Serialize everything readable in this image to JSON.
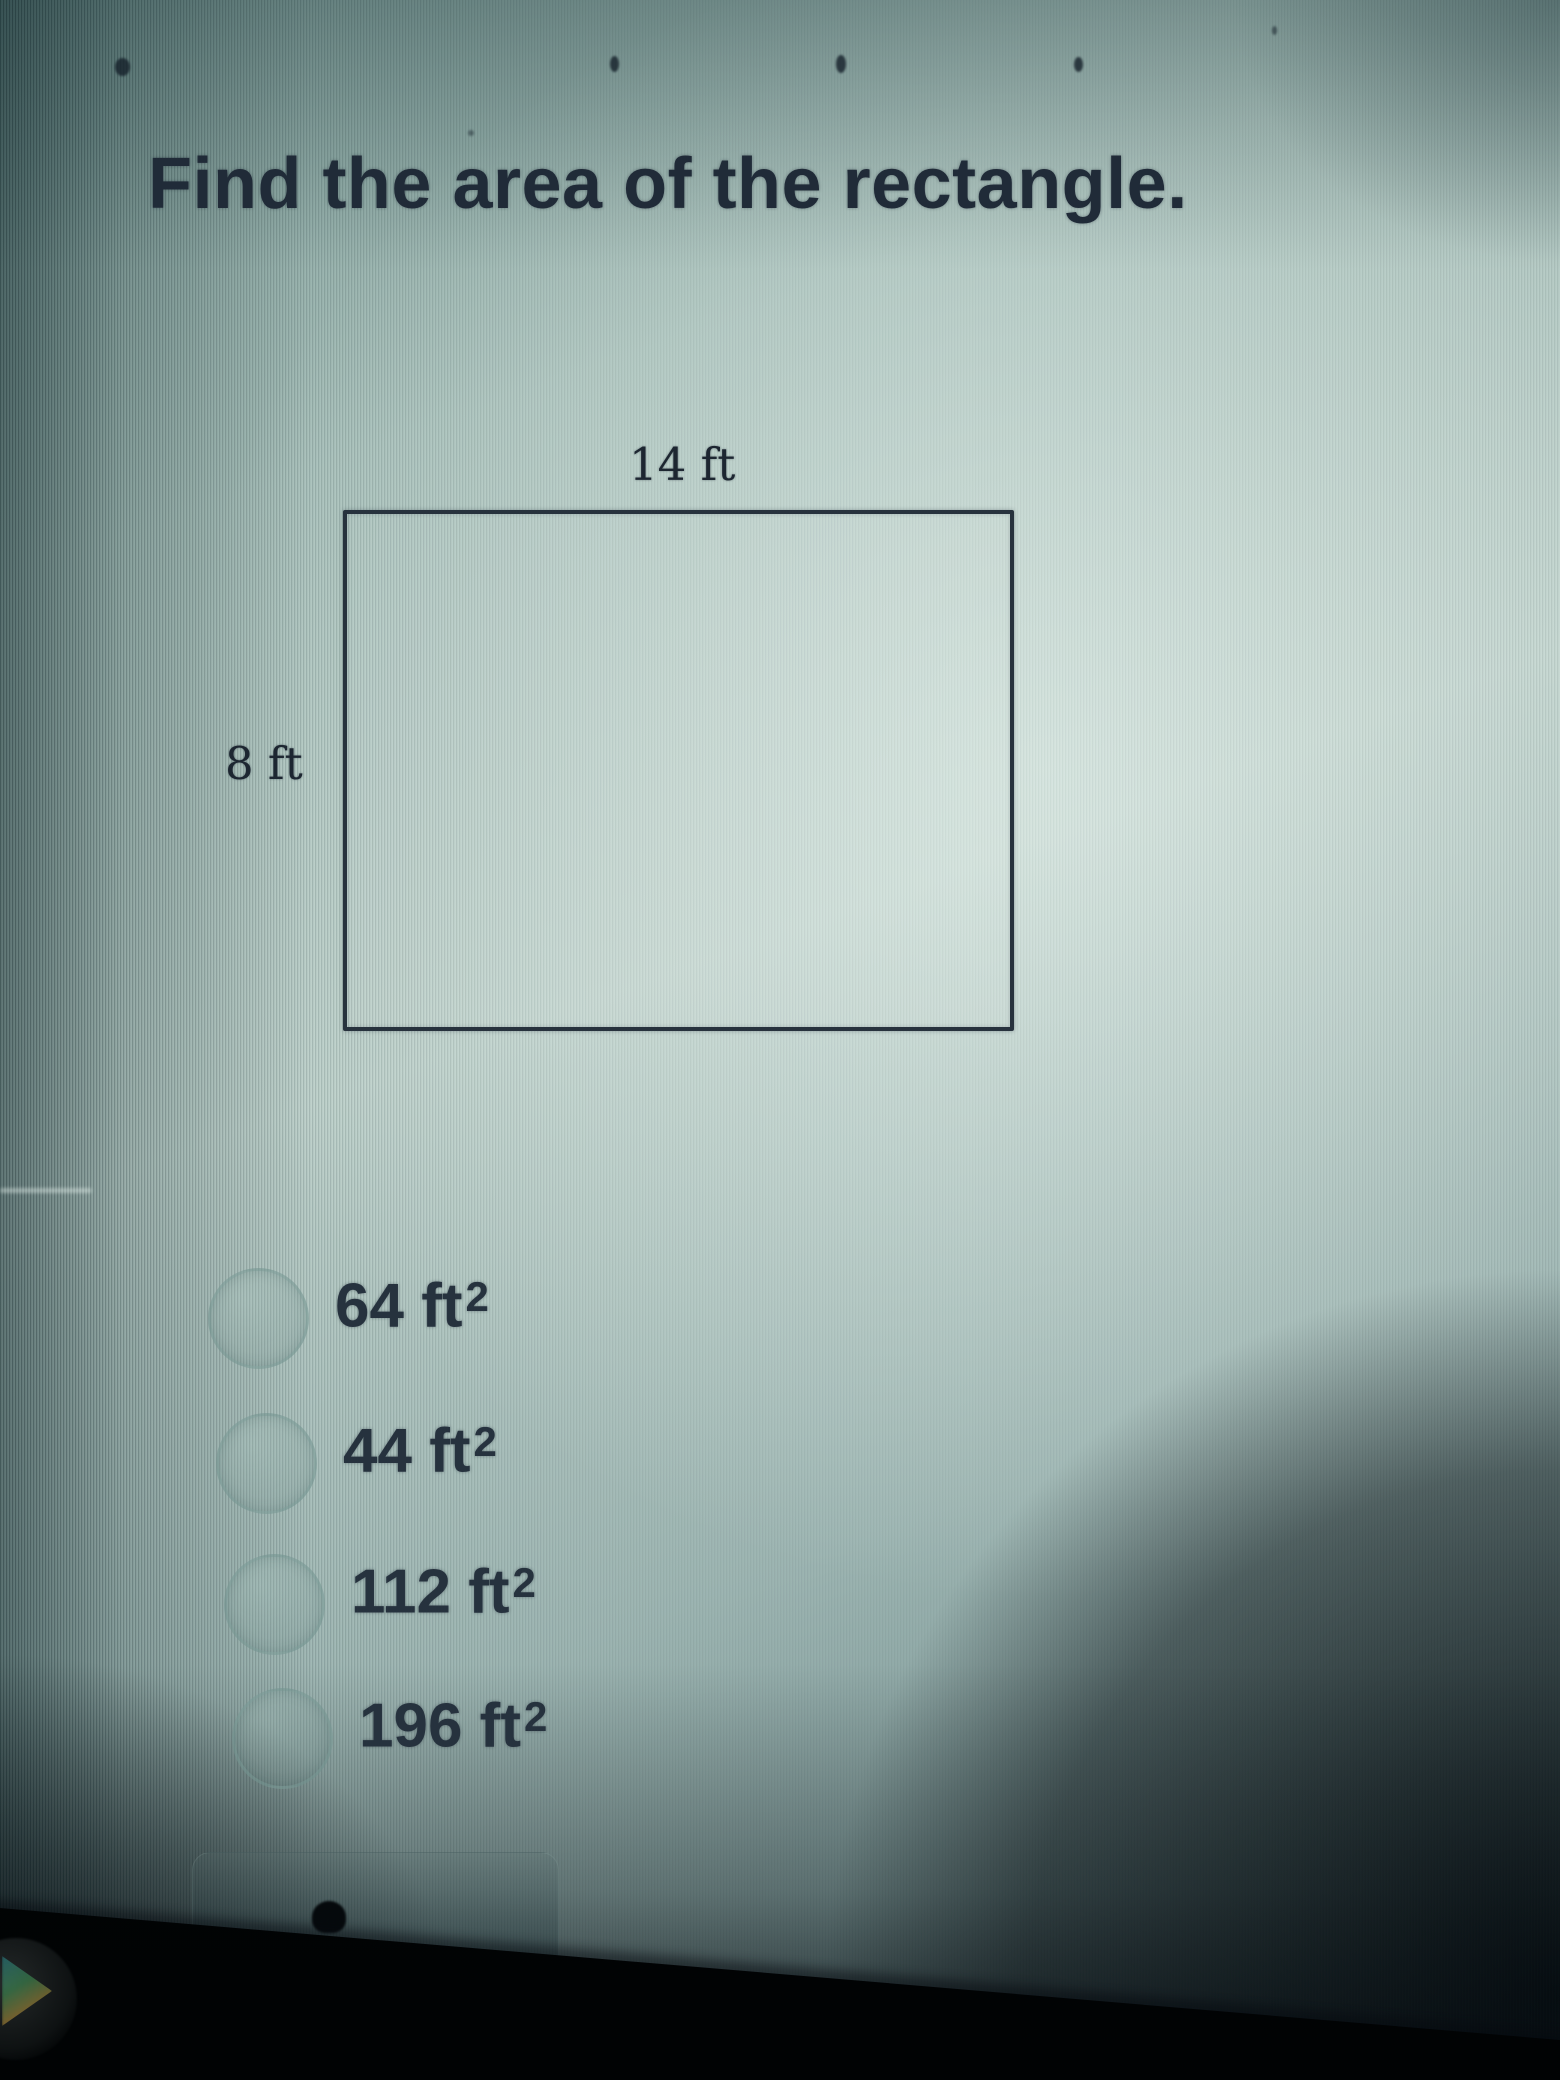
{
  "question": {
    "title": "Find the area of the rectangle."
  },
  "diagram": {
    "shape": "rectangle",
    "top_label": "14 ft",
    "side_label": "8 ft"
  },
  "options": [
    {
      "text": "64 ft",
      "sup": "2"
    },
    {
      "text": "44 ft",
      "sup": "2"
    },
    {
      "text": "112 ft",
      "sup": "2"
    },
    {
      "text": "196 ft",
      "sup": "2"
    }
  ],
  "colors": {
    "ink": "#222e3a",
    "screen_highlight": "#c9dbd4",
    "screen_shadow": "#2c4549",
    "bezel": "#05090c"
  }
}
